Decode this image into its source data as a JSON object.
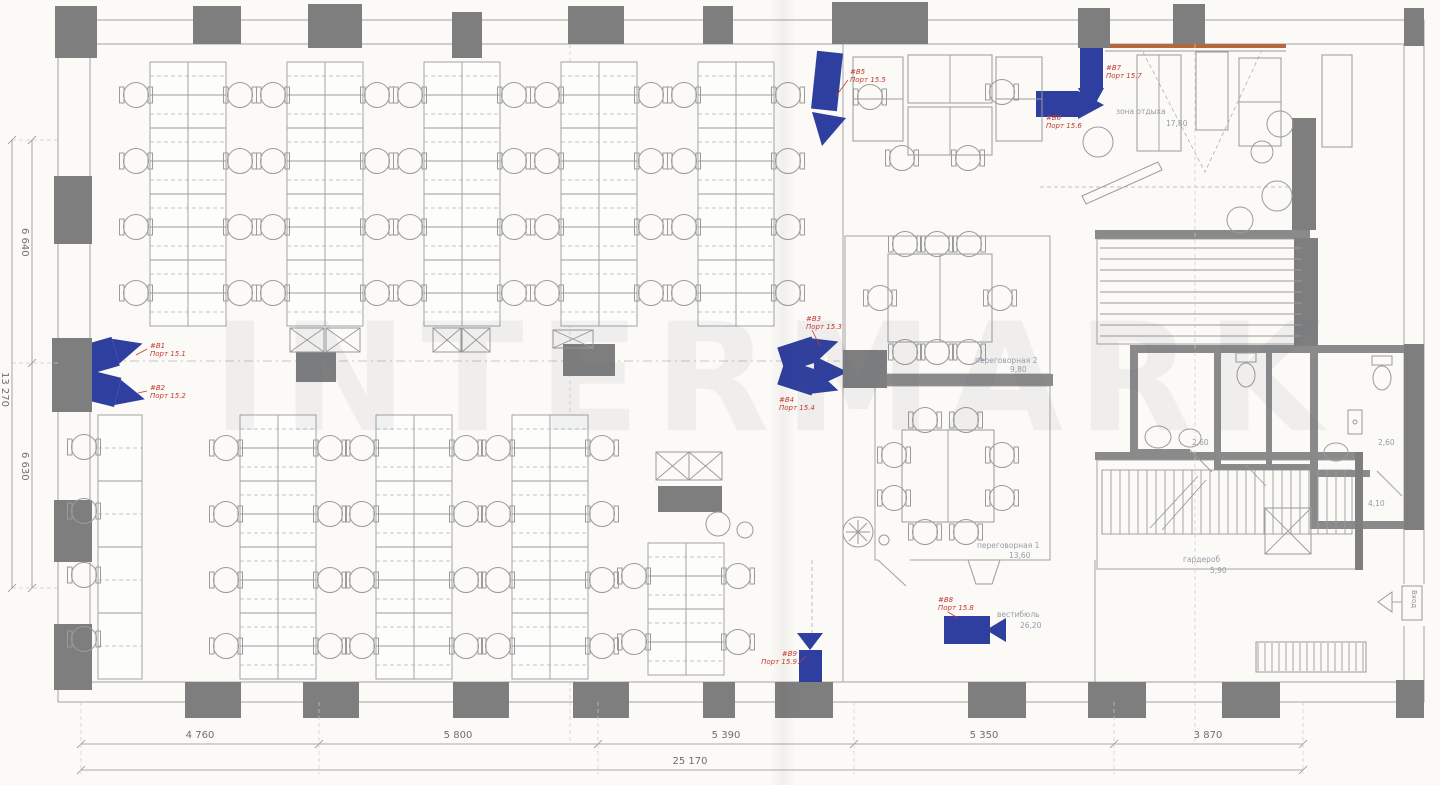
{
  "watermark": "INTERMARK",
  "dimensions": {
    "bottom": [
      "4 760",
      "5 800",
      "5 390",
      "5 350",
      "3 870"
    ],
    "bottom_total": "25 170",
    "left": [
      "6 640",
      "6 630"
    ],
    "left_total": "13 270"
  },
  "rooms": {
    "rest": {
      "name": "зона отдыха",
      "area": "17,80"
    },
    "meeting2": {
      "name": "переговорная 2",
      "area": "9,80"
    },
    "meeting1": {
      "name": "переговорная 1",
      "area": "13,60"
    },
    "lobby": {
      "name": "вестибюль",
      "area": "26,20"
    },
    "wardrobe": {
      "name": "гардероб",
      "area": "5,90"
    },
    "wc_left": {
      "area": "2,60"
    },
    "wc_right": {
      "area": "2,60"
    },
    "wc_small": {
      "area": "4,10"
    },
    "entrance": {
      "name": "Вход"
    }
  },
  "cameras": {
    "c1": {
      "id": "#В1",
      "port": "Порт 15.1"
    },
    "c2": {
      "id": "#В2",
      "port": "Порт 15.2"
    },
    "c3": {
      "id": "#В3",
      "port": "Порт 15.3"
    },
    "c4": {
      "id": "#В4",
      "port": "Порт 15.4"
    },
    "c5": {
      "id": "#В5",
      "port": "Порт 15.5"
    },
    "c6": {
      "id": "#В6",
      "port": "Порт 15.6"
    },
    "c7": {
      "id": "#В7",
      "port": "Порт 15.7"
    },
    "c8": {
      "id": "#В8",
      "port": "Порт 15.8"
    },
    "c9": {
      "id": "#В9",
      "port": "Порт 15.9"
    }
  },
  "colors": {
    "camera_blue": "#2e3f9f",
    "label_red": "#c23a30",
    "column_gray": "#7e7e7e",
    "wall_gray": "#8a8a8a",
    "accent_orange": "#b5683c"
  }
}
